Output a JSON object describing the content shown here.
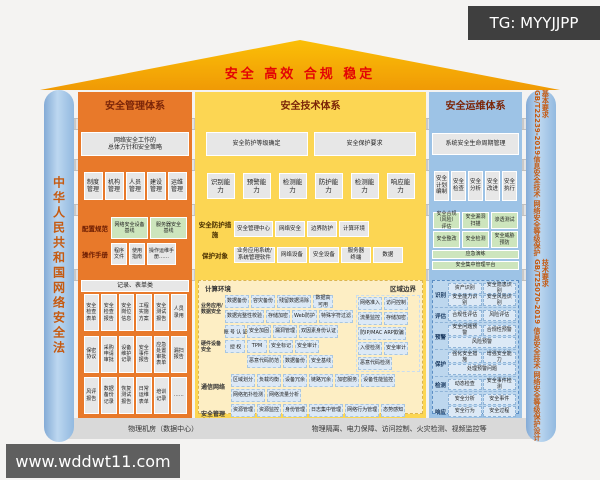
{
  "watermarks": {
    "top": "TG: MYYJJPP",
    "bottom": "www.wddwt11.com"
  },
  "roof": {
    "slogan": "安全 高效 合规 稳定"
  },
  "pillars": {
    "left": "中华人民共和国网络安全法",
    "right1": "GB/T22239-2019信息安全技术 网络安全等级保护基本要求",
    "right2": "GB/T25070-2019 信息安全技术 网络安全等级保护设计技术要求"
  },
  "bands": {
    "req": "需求",
    "purpose": "目的",
    "plan": "计划",
    "impl": "实施"
  },
  "mgmt": {
    "title": "安全管理体系",
    "req": "网络安全工作的\n总体方针和安全策略",
    "purpose": [
      "制度管理",
      "机构管理",
      "人员管理",
      "建设管理",
      "运维管理"
    ],
    "plan_row1_label": "配置规范",
    "plan_row1_items": [
      "网络安全设备\n基线",
      "服务器安全\n基线"
    ],
    "plan_row2_label": "操作手册",
    "plan_row2_items": [
      "程序\n文件",
      "使用\n指南",
      "操作运维手\n册……"
    ],
    "impl_header": "记录、表单类",
    "impl_items": [
      "安全检查表单",
      "安全检查报告",
      "安全岗位信息",
      "工程实施方案",
      "安全测试报告",
      "人员录用",
      "保密协议",
      "采购申请审批",
      "设备维护记录",
      "安全事件报告",
      "应急处置审批表单",
      "漏扫报告",
      "风评报告",
      "数据备份记录",
      "恢复测试报告",
      "日常运维表单",
      "培训记录",
      "……"
    ]
  },
  "tech": {
    "title": "安全技术体系",
    "req_items": [
      "安全防护等级确定",
      "安全保护要求"
    ],
    "purpose": [
      "识别能力",
      "预警能力",
      "检测能力",
      "防护能力",
      "检测能力",
      "响应能力"
    ],
    "plan_row1_label": "安全防护措施",
    "plan_row1_items": [
      "安全管理中心",
      "网络安全",
      "边界防护",
      "计算环境"
    ],
    "plan_row2_label": "保护对象",
    "plan_row2_items": [
      "业务应用系统/\n系统管理软件",
      "网络设备",
      "安全设备",
      "服务器\n终端",
      "数据"
    ],
    "impl": {
      "zone1_label": "计算环境",
      "zone2_label": "区域边界",
      "sub1_label": "业务应用/\n数据安全",
      "sub1_items": [
        "数据备份",
        "容灾备份",
        "残留数据清除",
        "数据高\n可用",
        "数据完整性校验",
        "存储加密",
        "Web防护",
        "特殊字符过滤"
      ],
      "sub2_label": "硬件设备\n安全",
      "sub2_vertical": [
        "账号认证",
        "授权"
      ],
      "sub2_items": [
        "安全加固",
        "漏洞管理",
        "双因素身份认证",
        "TPM",
        "安全标记",
        "安全审计",
        "恶意代码防范",
        "数据备份",
        "安全基线"
      ],
      "zone2_items": [
        "网络准入",
        "访问控制",
        "流量监控",
        "存储加密",
        "防IP/MAC ARP欺骗",
        "入侵检测",
        "安全审计",
        "恶意代码检测"
      ],
      "net_label": "通信网络",
      "net_items": [
        "区域划分",
        "负载均衡",
        "设备冗余",
        "链路冗余",
        "加密服务",
        "设备性能监控",
        "网络拓扑检测",
        "网络流量分析"
      ],
      "soc_label": "安全管理中心",
      "soc_items": [
        "资源管理",
        "资源监控",
        "身份管理",
        "日志集中管理",
        "网络行为管理",
        "态势感知",
        "运行监测"
      ]
    }
  },
  "ops": {
    "title": "安全运维体系",
    "req": "系统安全生命周期管理",
    "purpose": [
      "安全计划编制",
      "安全检查",
      "安全分析",
      "安全改进",
      "安全执行"
    ],
    "plan_r1": [
      "安全合规（风险）评估",
      "安全漏洞扫描",
      "渗透测试"
    ],
    "plan_r2": [
      "安全整改",
      "安全检测",
      "安全威胁预防"
    ],
    "plan_r3": "应急演练",
    "plan_r4": "安全集中管理平台",
    "impl_rows": {
      "r1_label": "识别",
      "r2_label": "评估",
      "r3_label": "预警",
      "r4_label": "保护",
      "r5_label": "检测",
      "r6_label": "响应"
    },
    "impl_r1": [
      "资产识别",
      "安全隐患识别",
      "安全能力识别",
      "安全风险识别"
    ],
    "impl_r2": [
      "合规性评估",
      "风险评估"
    ],
    "impl_r3": [
      "安全问题预警",
      "合规性预警",
      "风险预警"
    ],
    "impl_r4": [
      "强化安全措施",
      "增强安全能力",
      "处理预警问题"
    ],
    "impl_r5": [
      "动态检查",
      "安全事件检测"
    ],
    "impl_r6": [
      "安全分析",
      "安全事件",
      "安全行为",
      "安全过程",
      "应急响应"
    ]
  },
  "foundation": {
    "left": "物理机房（数据中心）",
    "right": "物理隔离、电力保障、访问控制、火灾检测、视频监控等"
  }
}
